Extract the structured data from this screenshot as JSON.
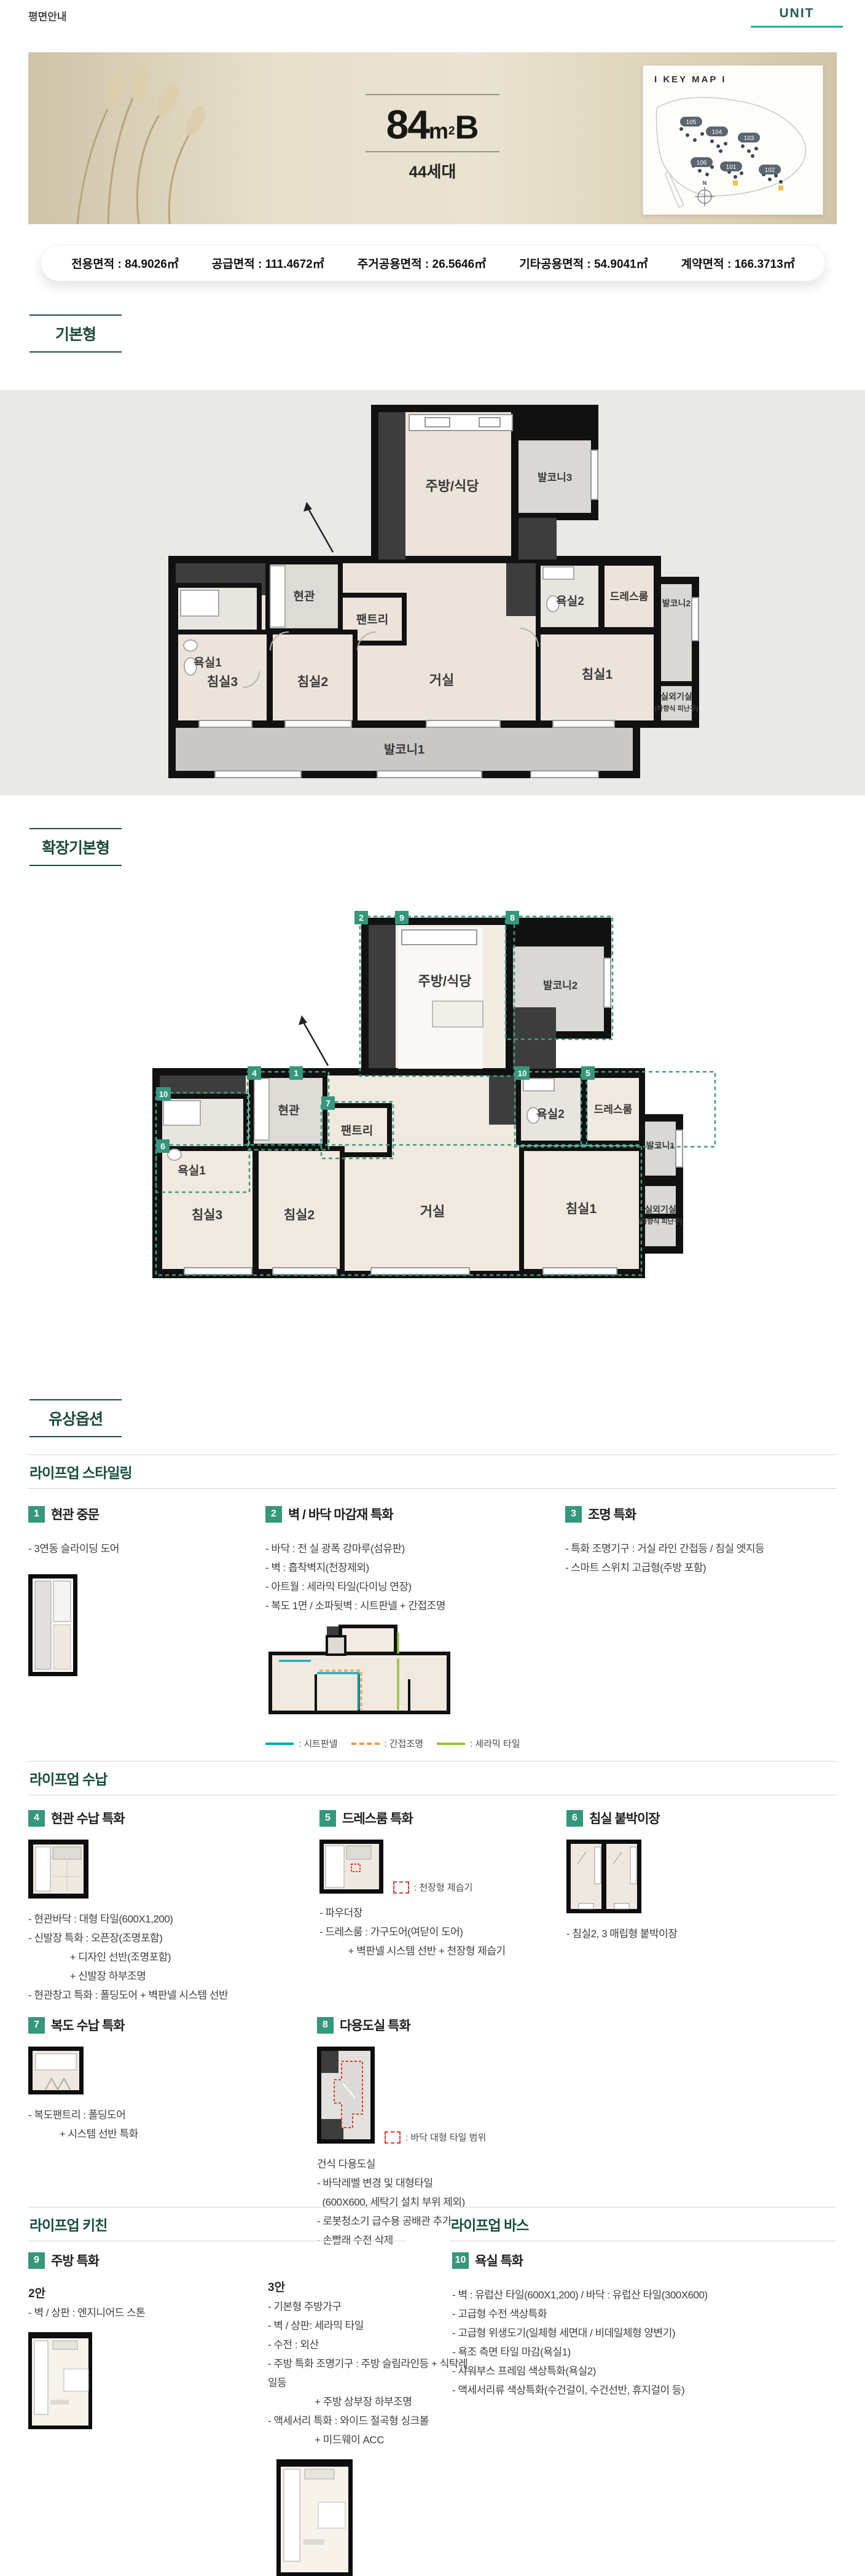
{
  "colors": {
    "accent_green": "#1b4a38",
    "chip_green": "#35977c",
    "tab_teal": "#2ba79b",
    "unit_text": "#235a57",
    "legend_sheet": "#00a9b7",
    "legend_indirect": "#f0a13e",
    "legend_ceramic": "#97c33c",
    "legend_red": "#e0392f",
    "plan_wall": "#111111",
    "plan_room": "#ece4db",
    "plan_balcony": "#c9c8c6"
  },
  "header": {
    "title": "평면안내",
    "unit_label": "UNIT"
  },
  "hero": {
    "area_number": "84",
    "area_unit_base": "m",
    "area_unit_exp": "2",
    "type_suffix": "B",
    "households": "44세대",
    "keymap": {
      "title": "I KEY MAP I",
      "north": "N",
      "buildings": [
        "105",
        "104",
        "103",
        "106",
        "101",
        "102"
      ]
    }
  },
  "area_info": {
    "items": [
      "전용면적 : 84.9026㎡",
      "공급면적 : 111.4672㎡",
      "주거공용면적 : 26.5646㎡",
      "기타공용면적 : 54.9041㎡",
      "계약면적 : 166.3713㎡"
    ]
  },
  "section_labels": {
    "basic": "기본형",
    "extended": "확장기본형",
    "paid_options": "유상옵션"
  },
  "plan_basic": {
    "rooms": {
      "kitchen": "주방/식당",
      "balcony3": "발코니3",
      "entrance": "현관",
      "pantry": "팬트리",
      "bath1": "욕실1",
      "bath2": "욕실2",
      "dressroom": "드레스룸",
      "balcony2": "발코니2",
      "bedroom3": "침실3",
      "bedroom2": "침실2",
      "living": "거실",
      "bedroom1": "침실1",
      "outdoor_room": "실외기실",
      "outdoor_room_sub": "(하향식 피난구)",
      "balcony1": "발코니1"
    }
  },
  "plan_extended": {
    "rooms": {
      "kitchen": "주방/식당",
      "balcony2": "발코니2",
      "entrance": "현관",
      "pantry": "팬트리",
      "bath1": "욕실1",
      "bath2": "욕실2",
      "dressroom": "드레스룸",
      "balcony1": "발코니1",
      "bedroom3": "침실3",
      "bedroom2": "침실2",
      "living": "거실",
      "bedroom1": "침실1",
      "outdoor_room": "실외기실",
      "outdoor_room_sub": "(하향식 피난구)"
    },
    "tags": [
      "2",
      "9",
      "8",
      "4",
      "1",
      "7",
      "10",
      "10",
      "5",
      "6"
    ]
  },
  "lifeup_styling": {
    "heading": "라이프업 스타일링",
    "items": [
      {
        "no": "1",
        "title": "현관 중문",
        "lines": [
          "- 3연동 슬라이딩 도어"
        ]
      },
      {
        "no": "2",
        "title": "벽 / 바닥 마감재 특화",
        "lines": [
          "- 바닥 : 전 실 광폭 강마루(섬유판)",
          "- 벽 : 흡착벽지(천장제외)",
          "- 아트월 : 세라믹 타일(다이닝 연장)",
          "- 복도 1면 / 소파뒷벽 : 시트판넬 + 간접조명"
        ],
        "legend": [
          {
            "label": ": 시트판넬"
          },
          {
            "label": ": 간접조명"
          },
          {
            "label": ": 세라믹 타일"
          }
        ]
      },
      {
        "no": "3",
        "title": "조명 특화",
        "lines": [
          "- 특화 조명기구 : 거실 라인 간접등 / 침실 엣지등",
          "- 스마트 스위치 고급형(주방 포함)"
        ]
      }
    ]
  },
  "lifeup_storage": {
    "heading": "라이프업 수납",
    "items": [
      {
        "no": "4",
        "title": "현관 수납 특화",
        "lines": [
          "- 현관바닥 : 대형 타일(600X1,200)",
          "- 신발장 특화 : 오픈장(조명포함)",
          "                + 디자인 선반(조명포함)",
          "                + 신발장 하부조명",
          "- 현관창고 특화 : 폴딩도어 + 벽판넬 시스템 선반"
        ]
      },
      {
        "no": "5",
        "title": "드레스룸 특화",
        "legend_label": ": 천장형 제습기",
        "lines": [
          "- 파우더장",
          "- 드레스룸 : 가구도어(여닫이 도어)",
          "           + 벽판넬 시스템 선반 + 천장형 제습기"
        ]
      },
      {
        "no": "6",
        "title": "침실 붙박이장",
        "lines": [
          "- 침실2, 3 매립형 붙박이장"
        ]
      },
      {
        "no": "7",
        "title": "복도 수납 특화",
        "lines": [
          "- 복도팬트리 : 폴딩도어",
          "            + 시스템 선반 특화"
        ]
      },
      {
        "no": "8",
        "title": "다용도실 특화",
        "legend_label": ": 바닥 대형 타일 범위",
        "lines": [
          "건식 다용도실",
          "- 바닥레벨 변경 및 대형타일",
          "  (600X600, 세탁기 설치 부위 제외)",
          "- 로봇청소기 급수용 공배관 추가",
          "- 손빨래 수전 삭제"
        ]
      }
    ]
  },
  "lifeup_kitchen": {
    "heading": "라이프업 키친",
    "no": "9",
    "title": "주방 특화",
    "option2_label": "2안",
    "option2_lines": [
      "- 벽 / 상판 : 엔지니어드 스톤"
    ],
    "option3_label": "3안",
    "option3_lines": [
      "- 기본형 주방가구",
      "- 벽 / 상판: 세라믹 타일",
      "- 수전 : 외산",
      "- 주방 특화 조명기구 : 주방 슬림라인등 + 식탁레일등",
      "                  + 주방 상부장 하부조명",
      "- 액세서리 특화 : 와이드 절곡형 싱크볼",
      "                  + 미드웨이 ACC"
    ]
  },
  "lifeup_bath": {
    "heading": "라이프업 바스",
    "no": "10",
    "title": "욕실 특화",
    "lines": [
      "- 벽 : 유럽산 타일(600X1,200) / 바닥 : 유럽산 타일(300X600)",
      "- 고급형 수전 색상특화",
      "- 고급형 위생도기(일체형 세면대 / 비데일체형 양변기)",
      "- 욕조 측면 타일 마감(욕실1)",
      "- 샤워부스 프레임 색상특화(욕실2)",
      "- 액세서리류 색상특화(수건걸이, 수건선반, 휴지걸이 등)"
    ]
  }
}
